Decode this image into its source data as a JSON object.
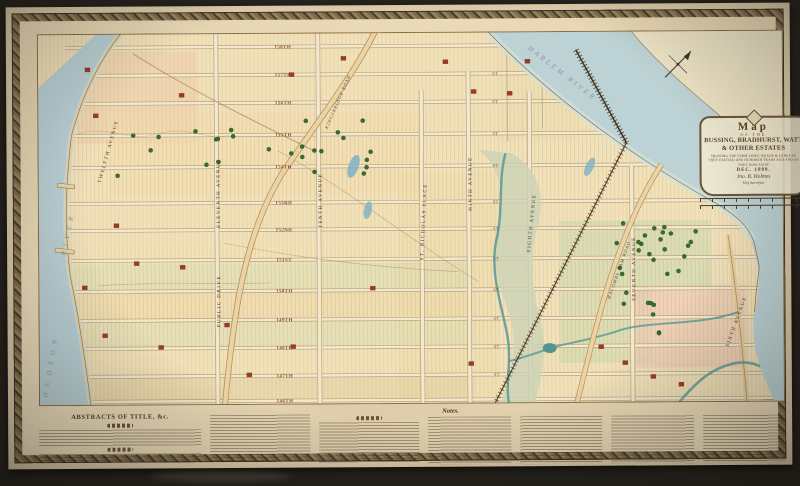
{
  "cartouche": {
    "word_map": "Map",
    "of_the": "OF THE",
    "names1": "BUSSING, BRADHURST, WATT",
    "names2": "& OTHER ESTATES",
    "subtitle": "SHOWING THE FARM LINES, ROADS & LANES AS THEY EXISTED ONE HUNDRED YEARS AGO AND AS THEY NOW EXIST",
    "date": "DEC. 1889.",
    "signature": "Jno. B. Holmes",
    "signature_title": "City Surveyor"
  },
  "bottom": {
    "abstracts_title": "ABSTRACTS OF TITLE, &c.",
    "notes_title": "Notes."
  },
  "map": {
    "label_x": 246,
    "stub_x": 458,
    "stub_label": "ST",
    "streets": [
      {
        "label": "158TH",
        "y": 14,
        "stub": false
      },
      {
        "label": "157TH",
        "y": 42,
        "stub": true
      },
      {
        "label": "156TH",
        "y": 70,
        "stub": true
      },
      {
        "label": "155TH",
        "y": 102,
        "stub": true
      },
      {
        "label": "154TH",
        "y": 134,
        "stub": true
      },
      {
        "label": "153RD",
        "y": 170,
        "stub": true
      },
      {
        "label": "152ND",
        "y": 197,
        "stub": true
      },
      {
        "label": "151ST",
        "y": 227,
        "stub": true
      },
      {
        "label": "150TH",
        "y": 258,
        "stub": true
      },
      {
        "label": "149TH",
        "y": 287,
        "stub": true
      },
      {
        "label": "148TH",
        "y": 315,
        "stub": true
      },
      {
        "label": "147TH",
        "y": 343,
        "stub": true
      },
      {
        "label": "146TH",
        "y": 368,
        "stub": false
      }
    ],
    "avenues": [
      {
        "label": "TWELFTH AVENUE",
        "x": 72,
        "y": 118,
        "rot": -74,
        "line_x": null,
        "y1": 0
      },
      {
        "label": "ELEVENTH AVENUE",
        "x": 182,
        "y": 160,
        "rot": -90,
        "line_x": 179,
        "y1": 0
      },
      {
        "label": "PUBLIC DRIVE",
        "x": 182,
        "y": 268,
        "rot": -90,
        "line_x": null,
        "y1": 0
      },
      {
        "label": "TENTH AVENUE",
        "x": 284,
        "y": 168,
        "rot": -90,
        "line_x": 281,
        "y1": 0
      },
      {
        "label": "ST. NICHOLAS PLACE",
        "x": 387,
        "y": 190,
        "rot": -87,
        "line_x": 384,
        "y1": 58
      },
      {
        "label": "NINTH AVENUE",
        "x": 434,
        "y": 152,
        "rot": -90,
        "line_x": 431,
        "y1": 40
      },
      {
        "label": "EIGHTH AVENUE",
        "x": 495,
        "y": 192,
        "rot": -84,
        "line_x": 492,
        "y1": 60
      },
      {
        "label": "SEVENTH AVENUE",
        "x": 597,
        "y": 238,
        "rot": -90,
        "line_x": 594,
        "y1": 135
      },
      {
        "label": "SIXTH AVENUE",
        "x": 699,
        "y": 292,
        "rot": -70,
        "line_x": null,
        "y1": 0
      }
    ],
    "roads": [
      {
        "label": "KINGSBRIDGE ROAD",
        "x": 302,
        "y": 70,
        "rot": -66
      },
      {
        "label": "MACOMBS DAM ROAD",
        "x": 582,
        "y": 240,
        "rot": -70
      }
    ],
    "water_labels": [
      {
        "label": "HUDSON",
        "x": 14,
        "y": 332,
        "rot": -80,
        "spacing": 6
      },
      {
        "label": "RIVER",
        "x": 32,
        "y": 200,
        "rot": -78,
        "spacing": 5
      },
      {
        "label": "HARLEM RIVER",
        "x": 524,
        "y": 44,
        "rot": 38,
        "spacing": 3
      }
    ]
  }
}
